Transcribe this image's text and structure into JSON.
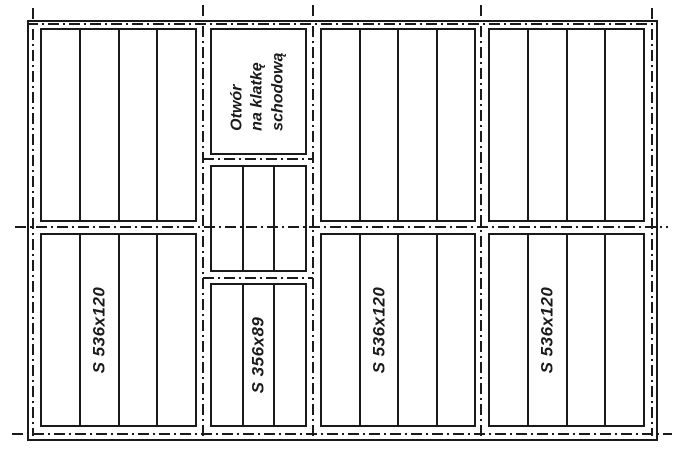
{
  "stair_opening": {
    "lines": [
      "Otwór",
      "na klatkę",
      "schodową"
    ]
  },
  "panels": [
    {
      "name": "top-left",
      "label": "",
      "slabs": 4
    },
    {
      "name": "stair-opening",
      "label": "Otwór na klatkę schodową",
      "slabs": 0
    },
    {
      "name": "middle-landing",
      "label": "",
      "slabs": 3
    },
    {
      "name": "top-center",
      "label": "",
      "slabs": 4
    },
    {
      "name": "top-right",
      "label": "",
      "slabs": 4
    },
    {
      "name": "bottom-left",
      "label": "S 536x120",
      "slabs": 4
    },
    {
      "name": "bottom-middle",
      "label": "S 356x89",
      "slabs": 3
    },
    {
      "name": "bottom-center",
      "label": "S 536x120",
      "slabs": 4
    },
    {
      "name": "bottom-right",
      "label": "S 536x120",
      "slabs": 4
    }
  ],
  "colors": {
    "line": "#1a1a1a",
    "background": "#ffffff"
  }
}
